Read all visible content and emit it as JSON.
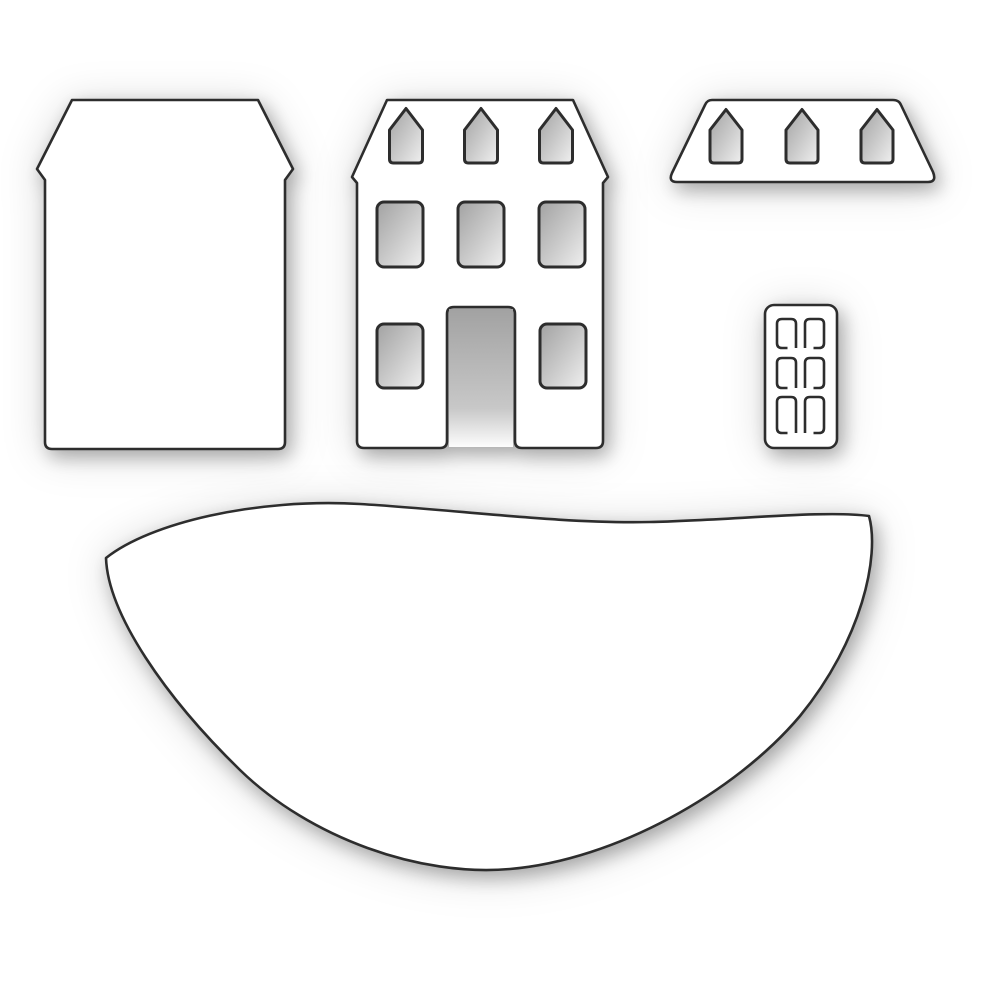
{
  "page": {
    "title": "White craft die set product image",
    "description": "Five white die-cut pieces on a white background: a plain house body, a house facade with windows and a door opening, a roof strip with dormer windows, a six-pane door, and a curved hill base"
  },
  "colors": {
    "page_bg": "#ffffff",
    "die_fill": "#ffffff",
    "outline": "#2d2d2d",
    "window_shade_dark": "#a2a2a2",
    "window_shade_mid": "#c8c8c8",
    "window_shade_light": "#f0f0f0"
  },
  "pieces": [
    {
      "id": "house-body",
      "label": "Plain house body die with angled roof top and eave notches"
    },
    {
      "id": "house-facade",
      "label": "House facade die with three pointed dormer windows, three upper windows, two lower windows and an open door notch"
    },
    {
      "id": "roof-strip",
      "label": "Trapezoid roof die with three pointed dormer windows"
    },
    {
      "id": "door-panel",
      "label": "Door die with six etched window panes in two columns"
    },
    {
      "id": "hill-base",
      "label": "Large curved hill base die with wavy top edge"
    }
  ],
  "counts": {
    "pieces": 5,
    "facade_dormers": 3,
    "facade_upper_windows": 3,
    "facade_lower_windows": 2,
    "roof_dormers": 3,
    "door_panes": 6
  }
}
